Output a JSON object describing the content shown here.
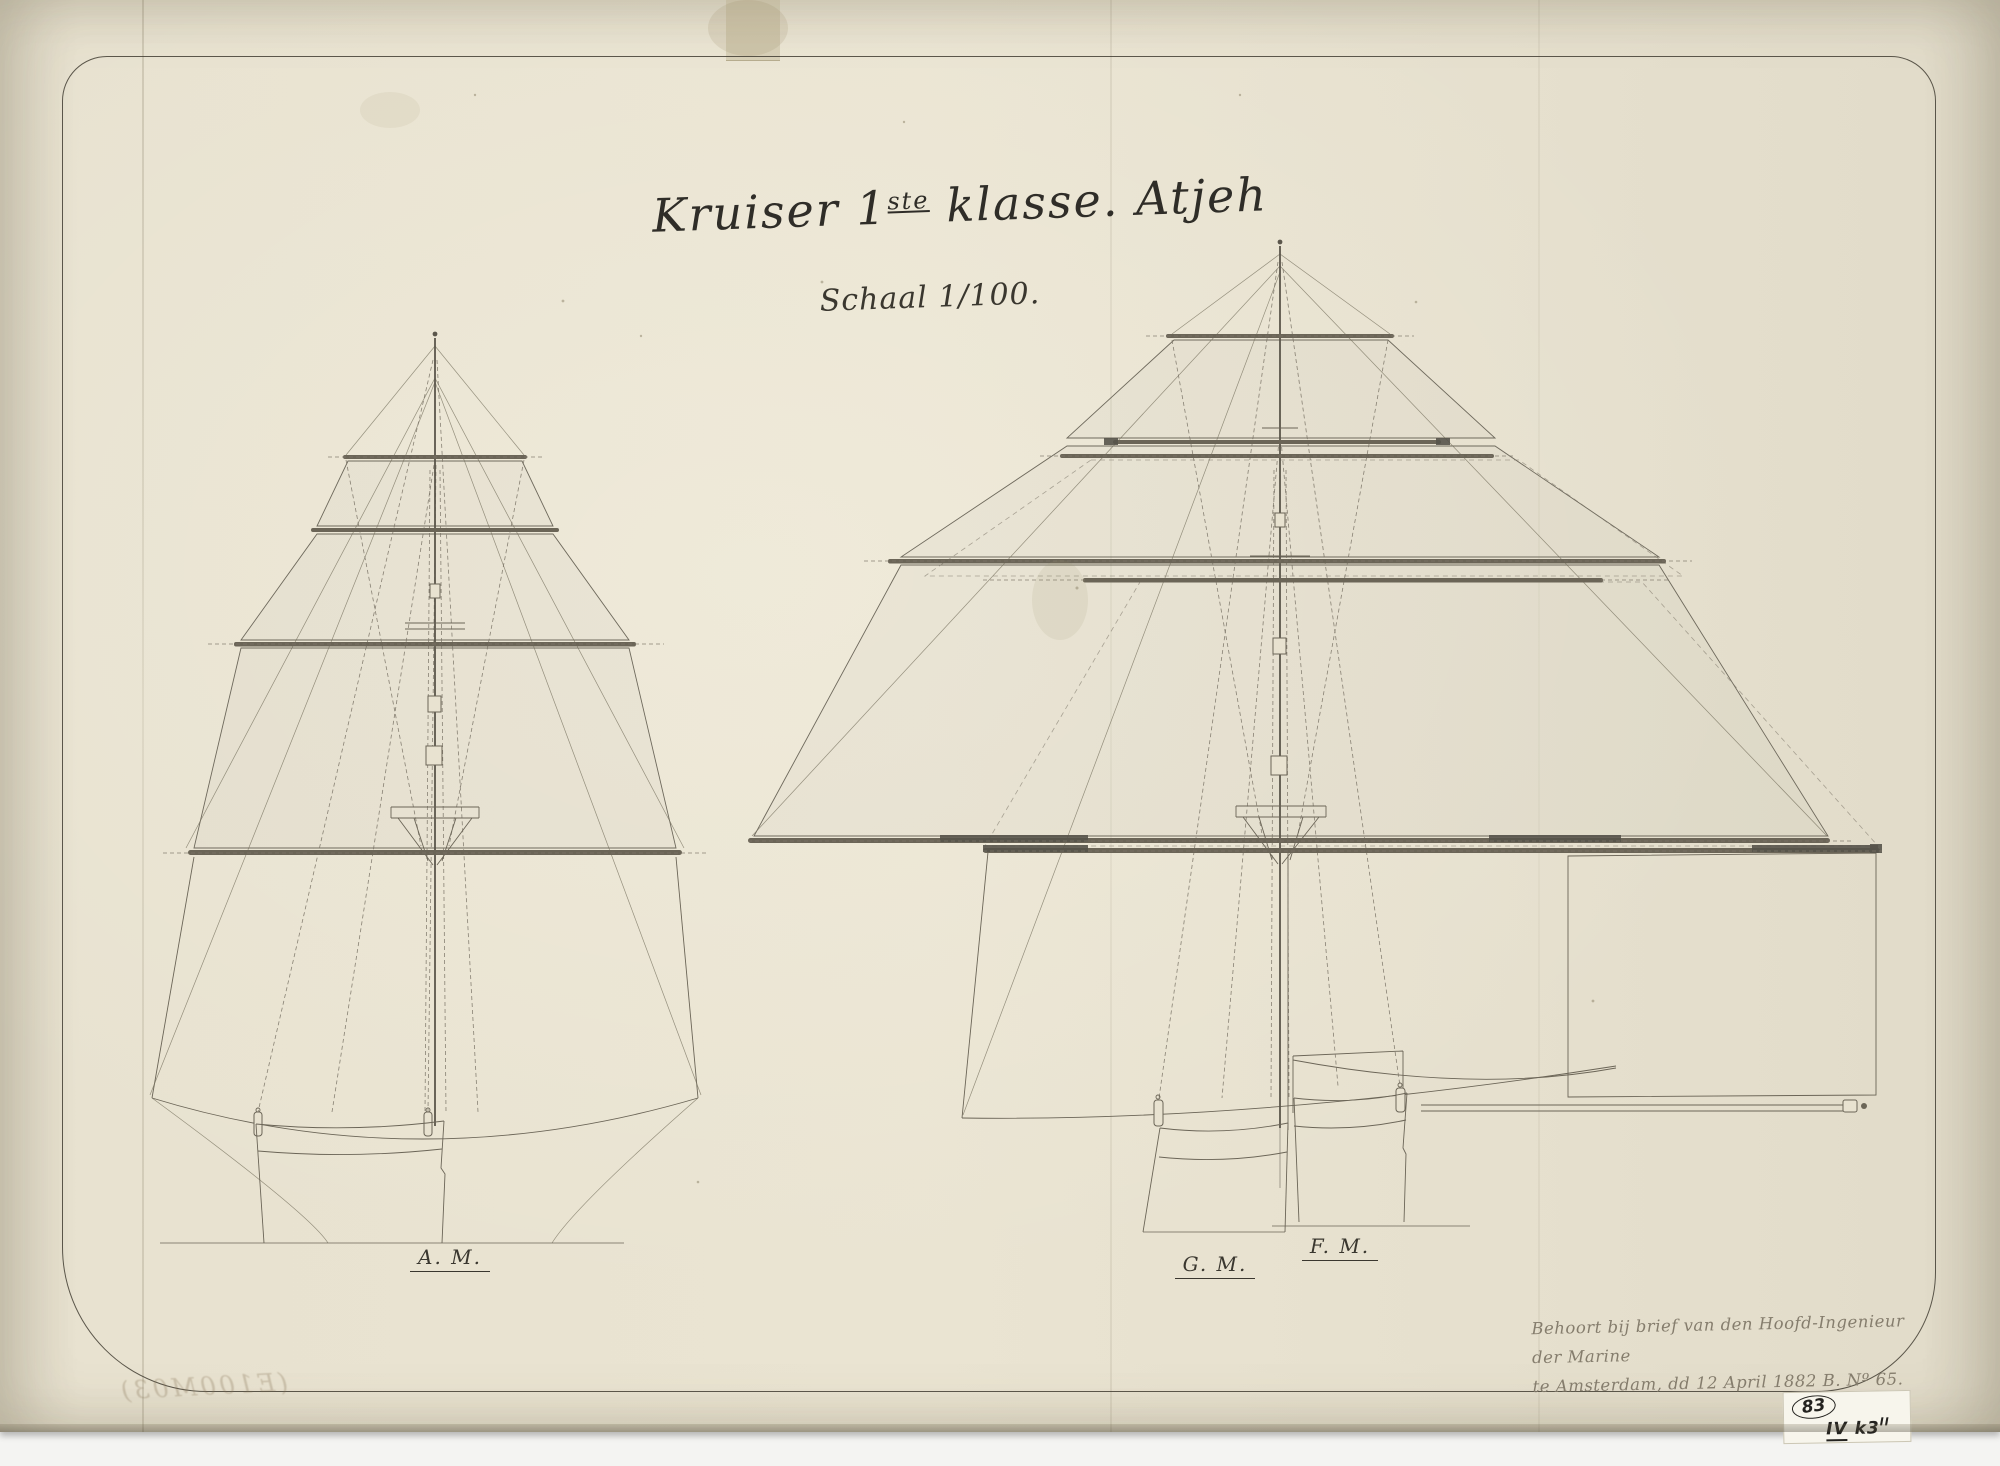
{
  "page": {
    "title": {
      "prefix": "Kruiser 1",
      "superscript": "ste",
      "suffix": " klasse. Atjeh"
    },
    "scale_label": "Schaal 1/100.",
    "mast_labels": {
      "aft": "A. M.",
      "main": "G. M.",
      "fore": "F. M."
    },
    "annotation": {
      "line1": "Behoort bij brief van den Hoofd-Ingenieur der Marine",
      "line2": "te Amsterdam, dd 12 April 1882 B. Nº 65."
    },
    "stamp": {
      "number": "83",
      "code_roman": "IV",
      "code_rest": " k3",
      "code_sup": "II"
    },
    "bleedthrough": "(E100M03)",
    "colors": {
      "paper": "#e8e2d0",
      "ink_title": "#2f2d28",
      "ink_line": "#6b6557",
      "ink_faded": "#857d6d",
      "backing": "#f4f4f2"
    }
  }
}
